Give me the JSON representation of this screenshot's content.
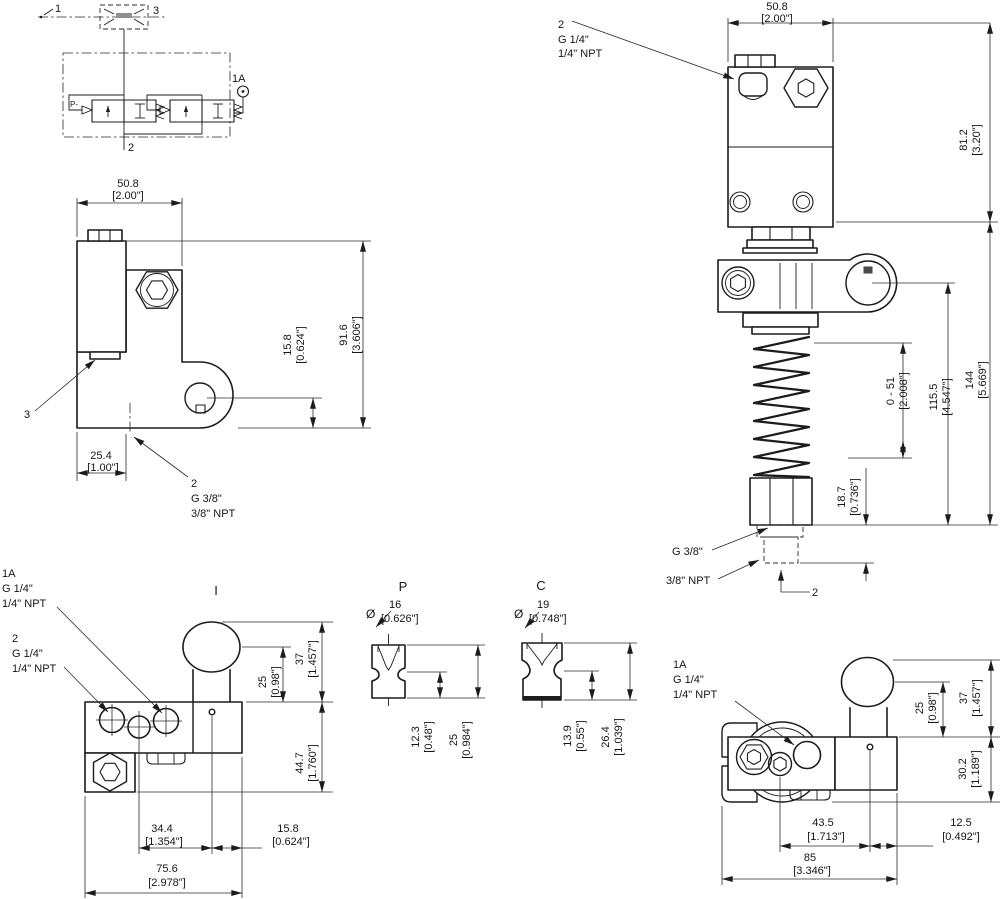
{
  "schematic": {
    "item_1": "1",
    "item_3": "3",
    "item_1a": "1A",
    "item_2": "2",
    "pilot_label": "P-"
  },
  "side_view": {
    "width_mm": "50.8",
    "width_in": "[2.00\"]",
    "height_mm": "91.6",
    "height_in": "[3.606\"]",
    "port_offset_mm": "15.8",
    "port_offset_in": "[0.624\"]",
    "base_mm": "25.4",
    "base_in": "[1.00\"]",
    "item_3": "3",
    "port_item": "2",
    "port_g": "G 3/8\"",
    "port_npt": "3/8\" NPT"
  },
  "front_view": {
    "width_mm": "50.8",
    "width_in": "[2.00\"]",
    "port_item": "2",
    "port_g": "G 1/4\"",
    "port_npt": "1/4\" NPT",
    "body_mm": "81.2",
    "body_in": "[3.20\"]",
    "total_mm": "144",
    "total_in": "[5.669\"]",
    "lower_mm": "115.5",
    "lower_in": "[4.547\"]",
    "adjust_mm": "0 - 51",
    "adjust_in": "[2.008\"]",
    "stub_mm": "18.7",
    "stub_in": "[0.736\"]",
    "bottom_g": "G 3/8\"",
    "bottom_npt": "3/8\" NPT",
    "bottom_item": "2"
  },
  "top_view": {
    "title": "I",
    "port1a_item": "1A",
    "port1a_g": "G 1/4\"",
    "port1a_npt": "1/4\" NPT",
    "port2_item": "2",
    "port2_g": "G 1/4\"",
    "port2_npt": "1/4\" NPT",
    "knob_center_mm": "25",
    "knob_center_in": "[0.98\"]",
    "knob_top_mm": "37",
    "knob_top_in": "[1.457\"]",
    "body_mm": "44.7",
    "body_in": "[1.760\"]",
    "spacing_mm": "34.4",
    "spacing_in": "[1.354\"]",
    "edge_mm": "15.8",
    "edge_in": "[0.624\"]",
    "width_mm": "75.6",
    "width_in": "[2.978\"]"
  },
  "detail_p": {
    "title": "P",
    "dia_symbol": "Ø",
    "dia_mm": "16",
    "dia_in": "[0.626\"]",
    "waist_mm": "12.3",
    "waist_in": "[0.48\"]",
    "height_mm": "25",
    "height_in": "[0.984\"]"
  },
  "detail_c": {
    "title": "C",
    "dia_symbol": "Ø",
    "dia_mm": "19",
    "dia_in": "[0.748\"]",
    "waist_mm": "13.9",
    "waist_in": "[0.55\"]",
    "height_mm": "26.4",
    "height_in": "[1.039\"]"
  },
  "side_view2": {
    "port1a_item": "1A",
    "port1a_g": "G 1/4\"",
    "port1a_npt": "1/4\" NPT",
    "knob_center_mm": "25",
    "knob_center_in": "[0.98\"]",
    "knob_top_mm": "37",
    "knob_top_in": "[1.457\"]",
    "body_mm": "30.2",
    "body_in": "[1.189\"]",
    "spacing_mm": "43.5",
    "spacing_in": "[1.713\"]",
    "edge_mm": "12.5",
    "edge_in": "[0.492\"]",
    "width_mm": "85",
    "width_in": "[3.346\"]"
  },
  "colors": {
    "line": "#1c1c1c",
    "background": "#ffffff"
  }
}
